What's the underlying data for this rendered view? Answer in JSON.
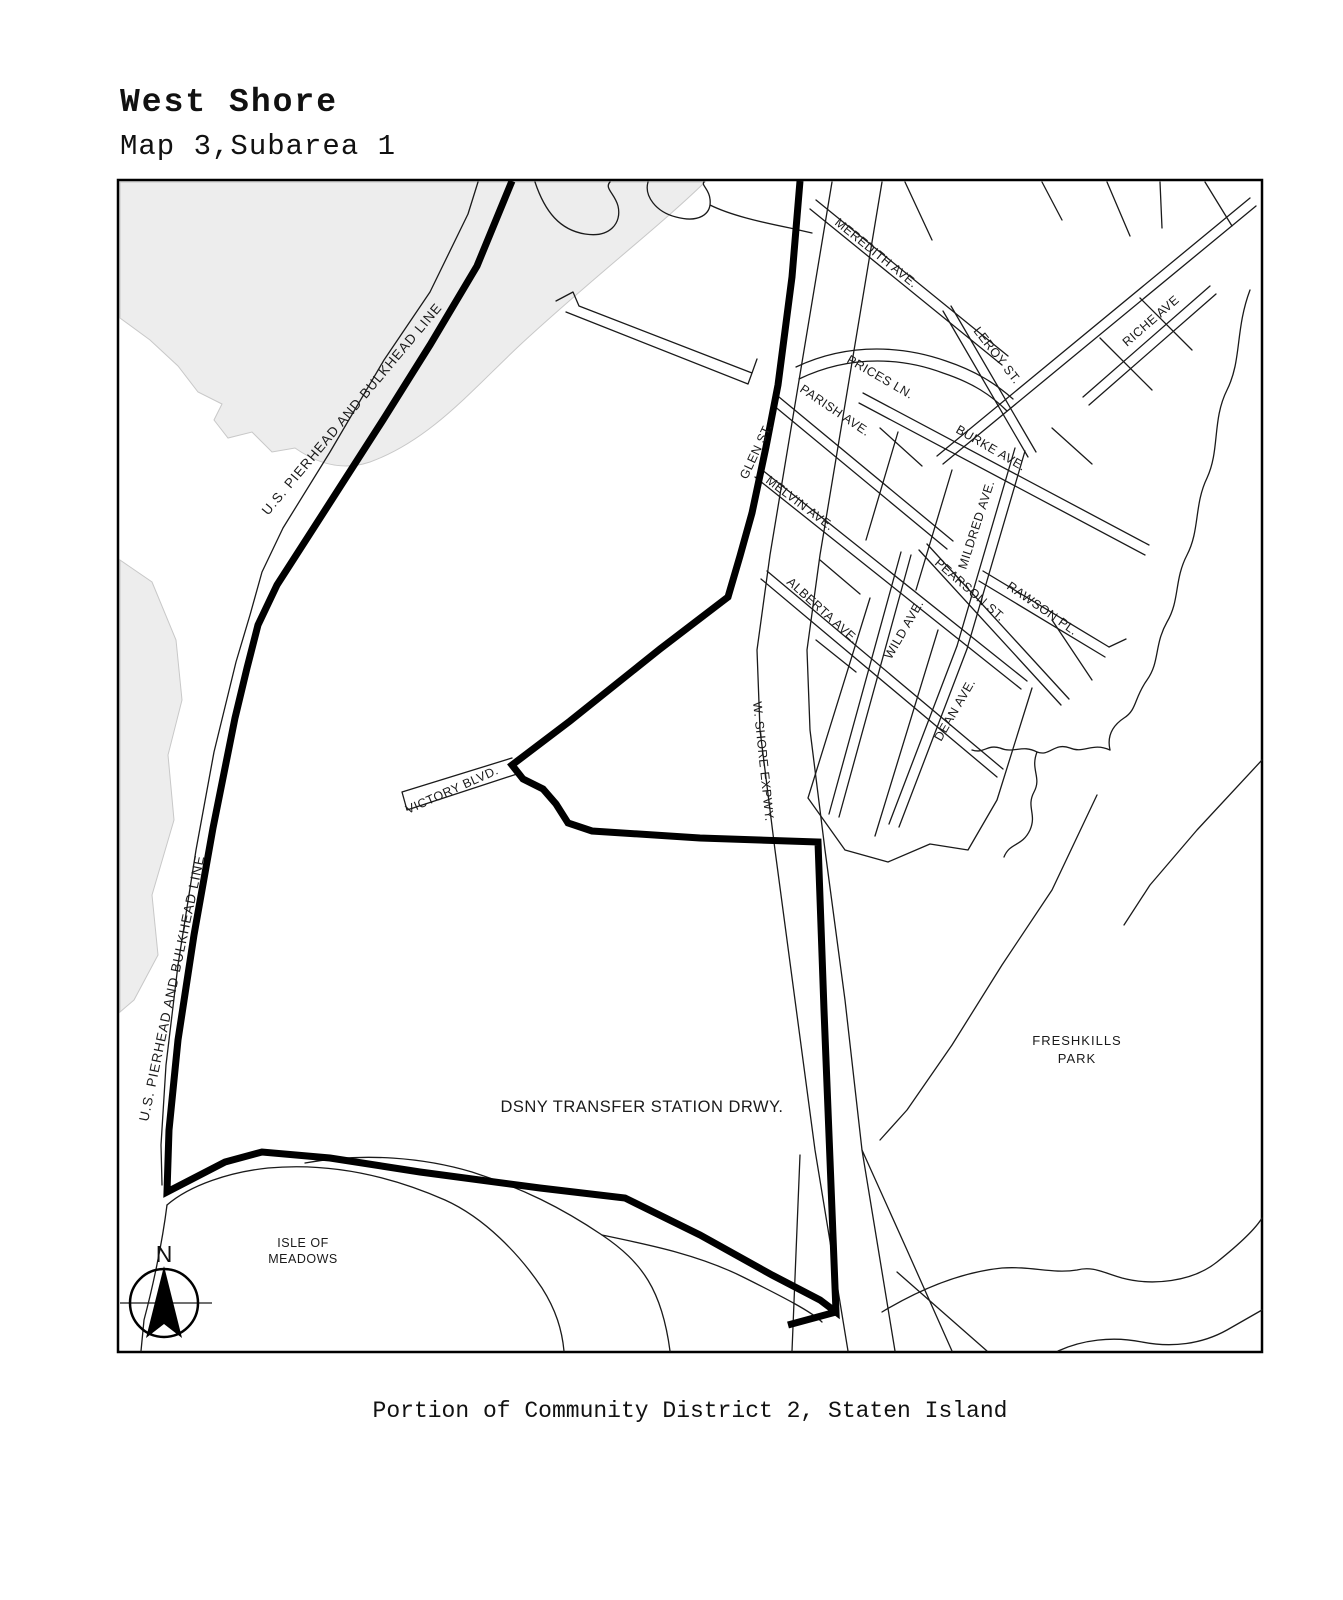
{
  "header": {
    "title": "West Shore",
    "subtitle": "Map 3,Subarea 1"
  },
  "caption": {
    "text": "Portion of Community District 2, Staten Island"
  },
  "compass": {
    "north": "N"
  },
  "colors": {
    "boundary": "#000000",
    "street_line": "#1a1a1a",
    "water_shade": "#ededed",
    "background": "#ffffff"
  },
  "map": {
    "labels": {
      "pierhead_upper": "U.S. PIERHEAD AND BULKHEAD LINE",
      "pierhead_lower": "U.S. PIERHEAD AND BULKHEAD LINE",
      "meredith_ave": "MEREDITH AVE.",
      "leroy_st": "LEROY ST.",
      "riche_ave": "RICHE AVE",
      "prices_ln": "PRICES LN.",
      "parish_ave": "PARISH AVE.",
      "burke_ave": "BURKE AVE.",
      "glen_st": "GLEN ST.",
      "melvin_ave": "MELVIN AVE.",
      "mildred_ave": "MILDRED AVE.",
      "pearson_st": "PEARSON ST.",
      "rawson_pl": "RAWSON PL.",
      "alberta_ave": "ALBERTA AVE.",
      "wild_ave": "WILD AVE.",
      "dean_ave": "DEAN AVE.",
      "w_shore_expwy": "W. SHORE EXPWY.",
      "victory_blvd": "VICTORY BLVD.",
      "dsny": "DSNY TRANSFER STATION DRWY.",
      "freshkills_1": "FRESHKILLS",
      "freshkills_2": "PARK",
      "isle_1": "ISLE OF",
      "isle_2": "MEADOWS"
    }
  }
}
